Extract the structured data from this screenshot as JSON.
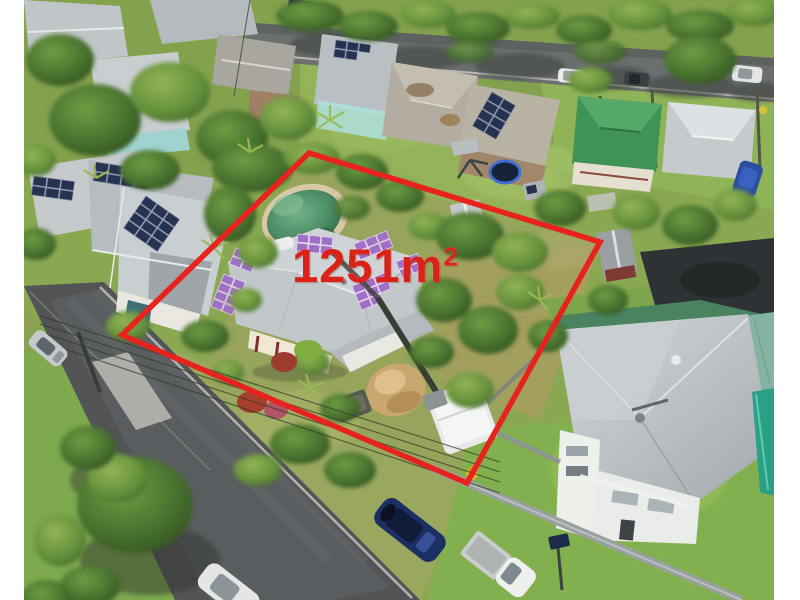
{
  "photo": {
    "kind": "aerial-drone-photo",
    "overlay": {
      "area_value": "1251m",
      "area_sup": "2",
      "boundary_color": "#e8231d",
      "boundary_points": "309,153 600,242 467,483 122,335",
      "label_color": "#da2318"
    },
    "palette": {
      "grass": "#8aa852",
      "grass_bright": "#9dbb5e",
      "lawn_bottom_right": "#83b04f",
      "tree_dark": "#2f4d26",
      "tree_mid": "#49732f",
      "tree_light": "#67923c",
      "road_top": "#6b6f6e",
      "road_left": "#525456",
      "roof_silver": "#c6cacd",
      "roof_rust": "#a08064",
      "roof_green": "#3f9356",
      "roof_mint": "#85b3a2",
      "solar_navy": "#263250",
      "solar_purple": "#a06fc6",
      "pool_green": "#45875f",
      "pool_teal": "#2aa186",
      "sand": "#c9a76f",
      "car_blue": "#1c2f63",
      "car_white": "#eef0ee",
      "margin": "#ffffff"
    }
  }
}
